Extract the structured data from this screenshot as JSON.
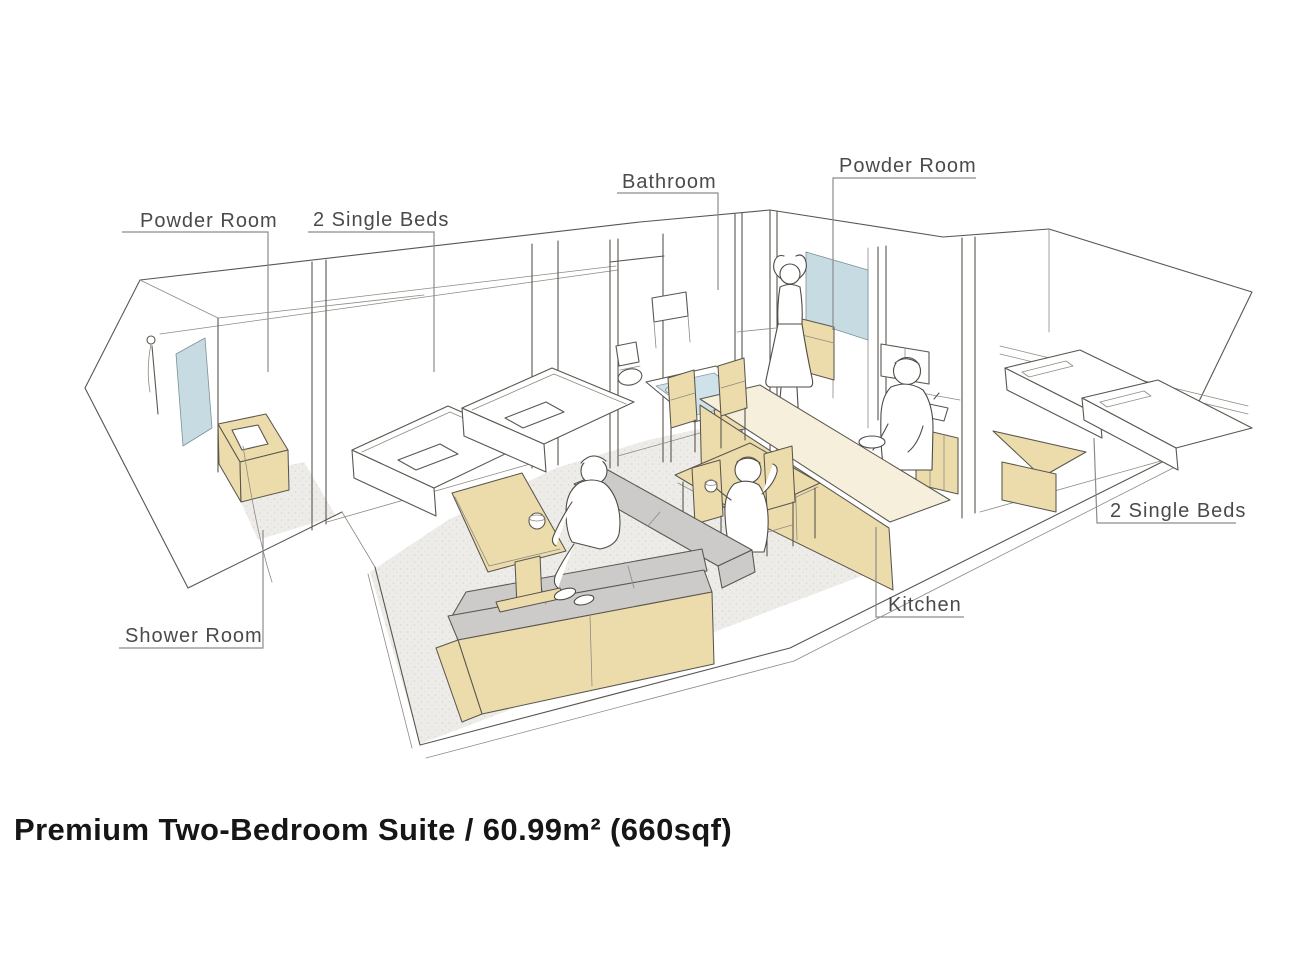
{
  "title": "Premium Two-Bedroom Suite / 60.99m² (660sqf)",
  "labels": {
    "powder_room_left": "Powder Room",
    "single_beds_left": "2 Single Beds",
    "bathroom": "Bathroom",
    "powder_room_right": "Powder Room",
    "shower_room": "Shower Room",
    "kitchen": "Kitchen",
    "single_beds_right": "2 Single Beds"
  },
  "colors": {
    "wood": "#eddcab",
    "wood_light": "#f6efdb",
    "cushion": "#cccbc9",
    "glass": "#c6dbe2",
    "water": "#cfe2e9",
    "carpet": "#eceae6",
    "line": "#5a564f",
    "label_text": "#4a4a4a",
    "title_text": "#161616"
  }
}
